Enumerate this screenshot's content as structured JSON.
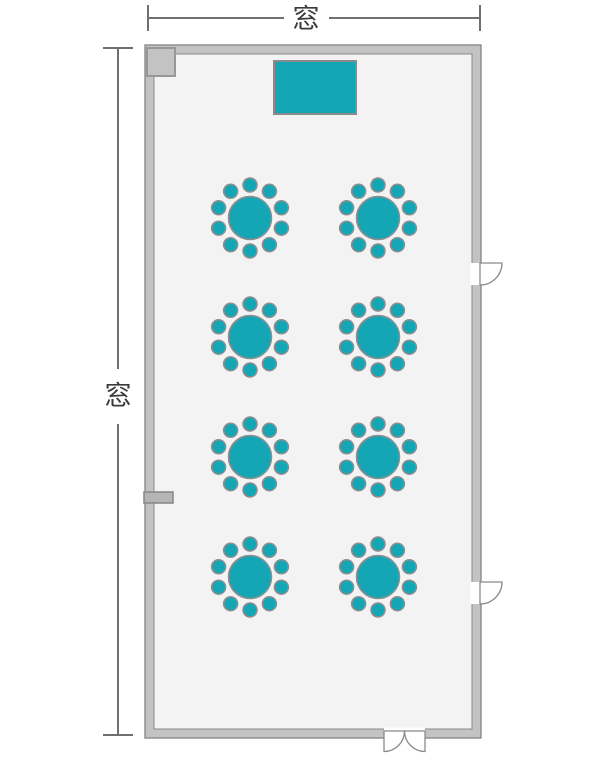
{
  "floorplan": {
    "kind": "banquet-room-seating-layout",
    "dimension_labels": {
      "top": "窓",
      "left": "窓"
    },
    "colors": {
      "accent": "#15a6b6",
      "outline": "#8e8e8e",
      "wall_fill": "#c3c3c3",
      "wall_stroke": "#8a8a8a",
      "floor_fill": "#f3f3f3",
      "block_fill": "#c3c3c3",
      "marker_fill": "#b5b5b5",
      "door_fill": "#ffffff",
      "dim_line": "#6f6f6f",
      "label_text": "#3b3b3b"
    },
    "tables": {
      "count": 8,
      "rows": 4,
      "columns": 2,
      "seats_per_table": 10,
      "table_radius": 21.5,
      "seat_radius": 7,
      "seat_ring_radius": 33,
      "positions": [
        [
          250,
          218
        ],
        [
          378,
          218
        ],
        [
          250,
          337
        ],
        [
          378,
          337
        ],
        [
          250,
          457
        ],
        [
          378,
          457
        ],
        [
          250,
          577
        ],
        [
          378,
          577
        ]
      ]
    },
    "doors": {
      "right_single_count": 2,
      "bottom_double_count": 1
    }
  }
}
